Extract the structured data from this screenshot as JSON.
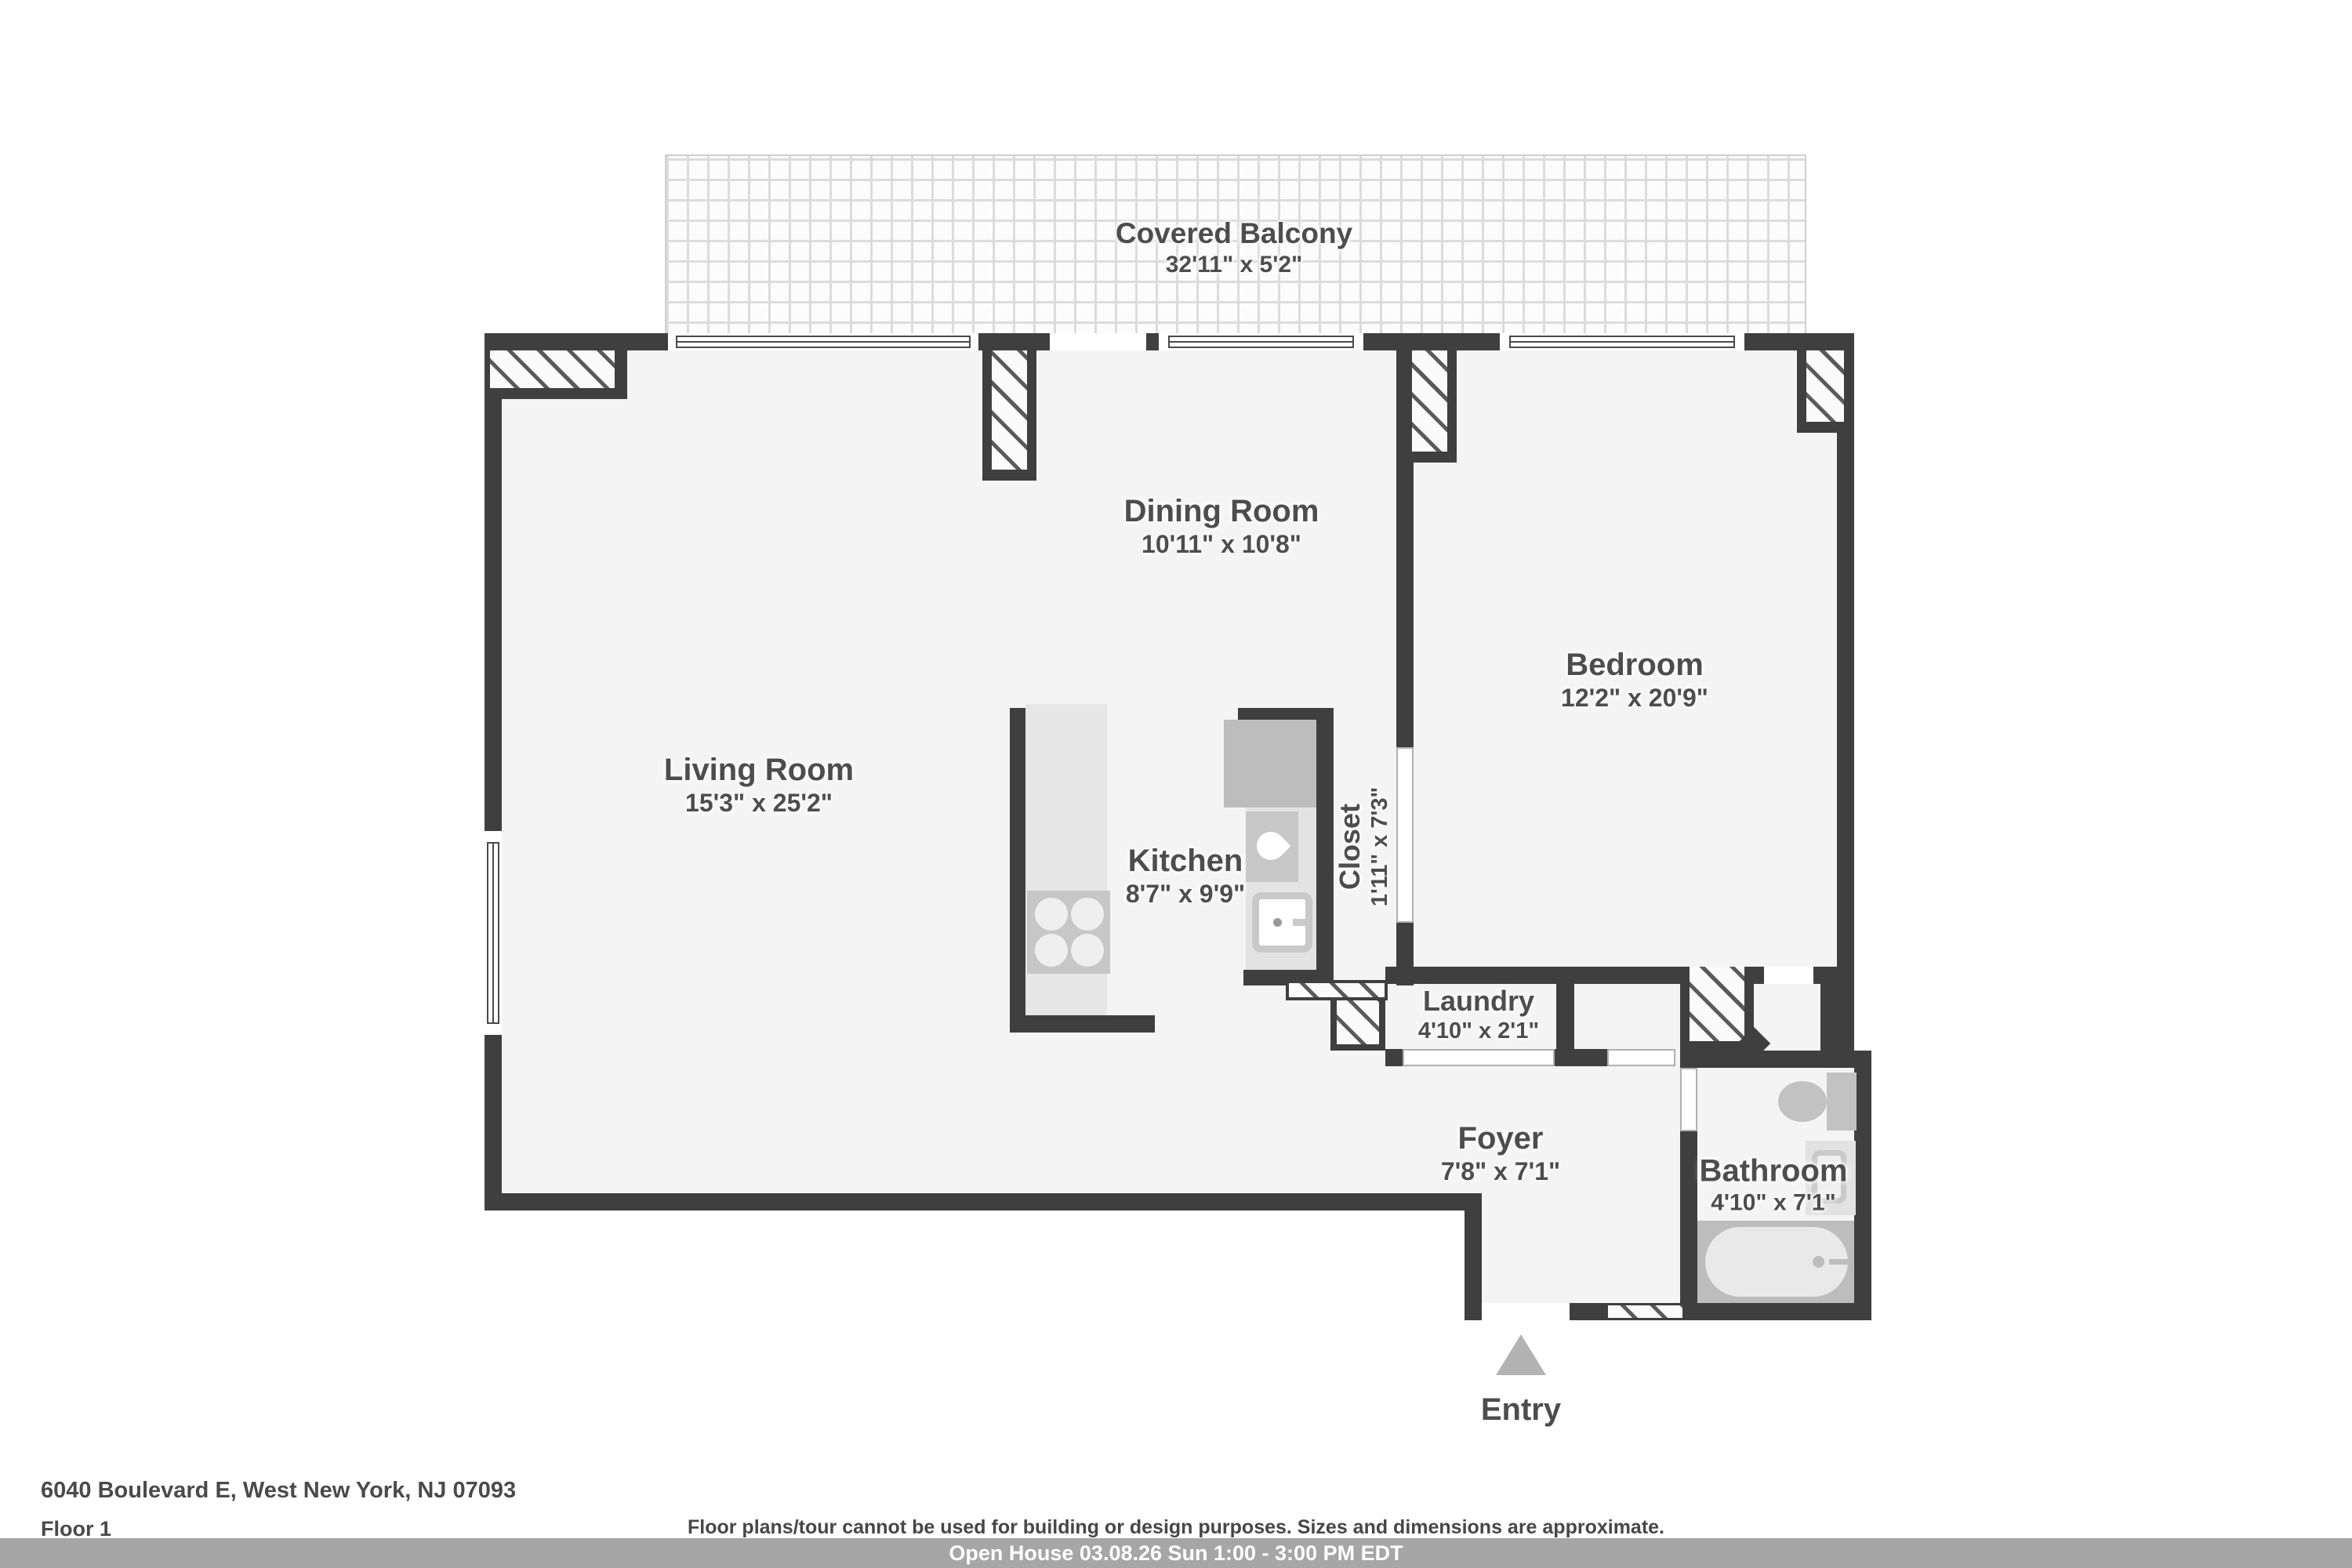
{
  "floorplan": {
    "balcony": {
      "name": "Covered Balcony",
      "dims": "32'11\" x 5'2\""
    },
    "rooms": {
      "dining": {
        "name": "Dining Room",
        "dims": "10'11\" x 10'8\""
      },
      "living": {
        "name": "Living Room",
        "dims": "15'3\" x 25'2\""
      },
      "bedroom": {
        "name": "Bedroom",
        "dims": "12'2\" x 20'9\""
      },
      "kitchen": {
        "name": "Kitchen",
        "dims": "8'7\" x 9'9\""
      },
      "closet": {
        "name": "Closet",
        "dims": "1'11\" x 7'3\""
      },
      "laundry": {
        "name": "Laundry",
        "dims": "4'10\" x 2'1\""
      },
      "foyer": {
        "name": "Foyer",
        "dims": "7'8\" x 7'1\""
      },
      "bathroom": {
        "name": "Bathroom",
        "dims": "4'10\" x 7'1\""
      }
    },
    "entry_label": "Entry",
    "fixtures": [
      "stove",
      "fridge",
      "sink",
      "dishwasher",
      "toilet",
      "vanity",
      "bathtub"
    ],
    "colors": {
      "wall": "#3f3f3f",
      "floor": "#f4f4f4",
      "label_text": "#4d4d4d",
      "counter": "#e7e7e7",
      "appliance": "#c2c2c2",
      "tub_zone": "#bdbdbd"
    }
  },
  "footer": {
    "address": "6040 Boulevard E, West New York, NJ 07093",
    "floor_label": "Floor 1",
    "disclaimer": "Floor plans/tour cannot be used for building or design purposes. Sizes and dimensions are approximate.",
    "banner": "Open House 03.08.26 Sun 1:00 - 3:00 PM EDT",
    "banner_bg": "#a6a6a6"
  }
}
